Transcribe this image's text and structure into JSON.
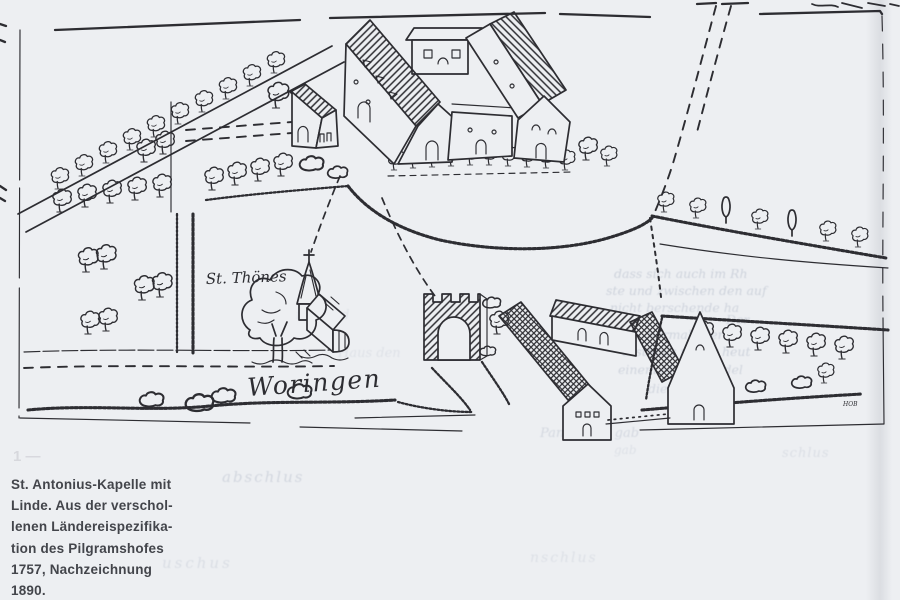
{
  "page": {
    "type": "scanned book page with hand-drawn map",
    "background": "#edeff2",
    "figure_marker": "1 —"
  },
  "map": {
    "ink_color": "#2d2d32",
    "label_st_thoenes": "St. Thönes",
    "label_woringen": "Woringen",
    "artist_mark": "HOB"
  },
  "caption": {
    "color": "#43454b",
    "lines": [
      "St. Antonius-Kapelle mit",
      "Linde. Aus der verschol-",
      "lenen Ländereispezifika-",
      "tion des Pilgramshofes",
      "1757, Nachzeichnung",
      "1890."
    ]
  },
  "ghost_text": {
    "note": "faint bleed-through from reverse page",
    "fragments": [
      "dass sich auch im Rh",
      "ste und zwischen den auf",
      "nicht berschende ha",
      "Der",
      "vormals der",
      "erstmals under heut",
      "einem Monalich del",
      "die Verhin-",
      "Pankratius gab",
      "in den d",
      "Haus den",
      "abschlus",
      "uschus",
      "nschlus",
      "schlus",
      "gab"
    ]
  }
}
